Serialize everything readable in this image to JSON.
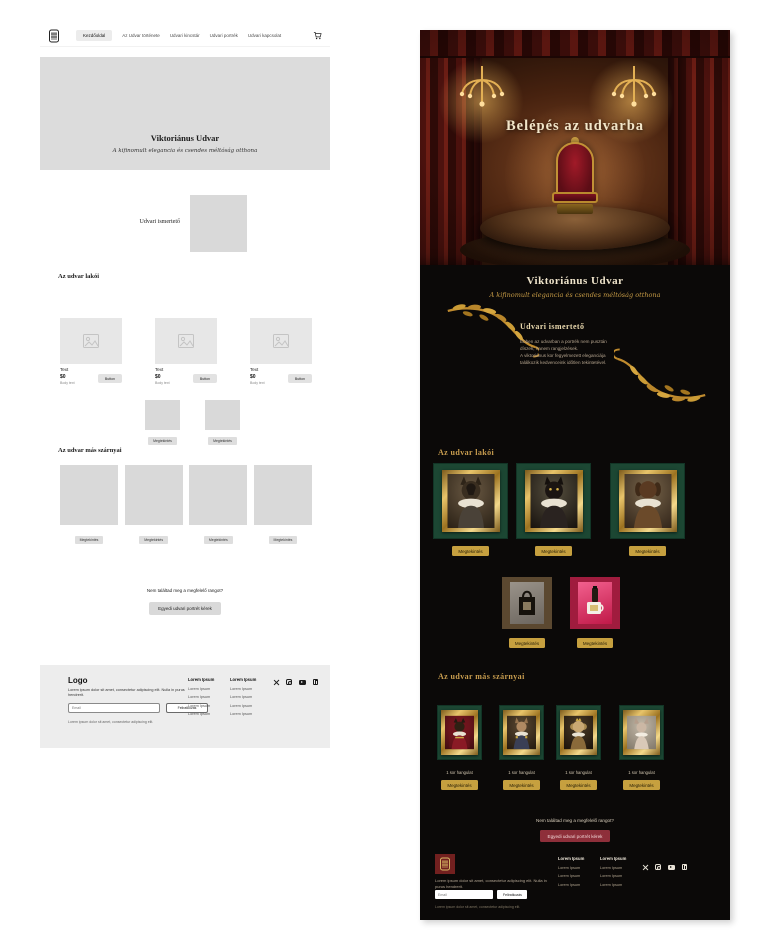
{
  "palette": {
    "gold": "#c6a03f",
    "gold_deep": "#b98a2e",
    "cream": "#efe4cb",
    "green_card": "#1c4733",
    "crimson_card": "#a01c3e",
    "brown_card": "#5b4830",
    "red_button": "#8e2f3a",
    "footer_logo_red": "#72201f",
    "dark_bg": "#0b0908",
    "wireframe_gray": "#d9d9d9"
  },
  "wireframe": {
    "nav": {
      "items": [
        "Kezdőoldal",
        "Az Udvar története",
        "Udvari kincstár",
        "Udvari portrék",
        "Udvari kapcsolat"
      ],
      "active_index": 0
    },
    "hero": {
      "title": "Viktoriánus Udvar",
      "subtitle": "A kifinomult elegancia és csendes méltóság otthona"
    },
    "intro": {
      "label": "Udvari ismertető"
    },
    "residents": {
      "heading": "Az udvar lakói",
      "cards": [
        {
          "title": "Text",
          "price": "$0",
          "body": "Body text",
          "button": "Button"
        },
        {
          "title": "Text",
          "price": "$0",
          "body": "Body text",
          "button": "Button"
        },
        {
          "title": "Text",
          "price": "$0",
          "body": "Body text",
          "button": "Button"
        }
      ]
    },
    "small_products": {
      "view_button": "Megtekintés"
    },
    "wings": {
      "heading": "Az udvar más szárnyai",
      "view_button": "Megtekintés"
    },
    "cta": {
      "question": "Nem találtad meg a megfelelő rangot?",
      "button": "Egyedi udvari portrét kérek"
    },
    "footer": {
      "logo": "Logo",
      "description": "Lorem ipsum dolor sit amet, consectetur adipiscing elit. Nulla in purus hendrerit.",
      "email_placeholder": "Email",
      "subscribe_button": "Feliratkozás",
      "note": "Lorem ipsum dolor sit amet, consectetur adipiscing elit.",
      "columns": [
        {
          "header": "Lorem Ipsum",
          "links": [
            "Lorem Ipsum",
            "Lorem Ipsum",
            "Lorem Ipsum",
            "Lorem Ipsum"
          ]
        },
        {
          "header": "Lorem Ipsum",
          "links": [
            "Lorem Ipsum",
            "Lorem Ipsum",
            "Lorem Ipsum",
            "Lorem Ipsum"
          ]
        }
      ],
      "socials": [
        "x",
        "instagram",
        "youtube",
        "linkedin"
      ]
    }
  },
  "design": {
    "hero": {
      "title": "Belépés az udvarba"
    },
    "title": "Viktoriánus Udvar",
    "subtitle": "A kifinomult elegancia és csendes méltóság otthona",
    "about": {
      "heading": "Udvari ismertető",
      "body": "Ebben az udvarban a portrék nem pusztán\ndíszek, hanem rangjelzések.\nA viktoriánus kor fegyelmezett eleganciája\ntalálkozik kedvenceink időtlen tekintetével."
    },
    "residents": {
      "heading": "Az udvar lakói",
      "cards": [
        {
          "portrait": "shepherd-dog-portrait",
          "button": "Megtekintés"
        },
        {
          "portrait": "black-cat-portrait",
          "button": "Megtekintés"
        },
        {
          "portrait": "dachshund-portrait",
          "button": "Megtekintés"
        }
      ]
    },
    "products": {
      "cards": [
        {
          "name": "tote-bag",
          "button": "Megtekintés"
        },
        {
          "name": "mug-and-bottle",
          "button": "Megtekintés"
        }
      ]
    },
    "wings": {
      "heading": "Az udvar más szárnyai",
      "cards": [
        {
          "caption": "1 sor hangulat",
          "button": "Megtekintés",
          "portrait": "dog-on-throne-portrait"
        },
        {
          "caption": "1 sor hangulat",
          "button": "Megtekintés",
          "portrait": "sphynx-officer-portrait"
        },
        {
          "caption": "1 sor hangulat",
          "button": "Megtekintés",
          "portrait": "pekingese-crown-portrait"
        },
        {
          "caption": "1 sor hangulat",
          "button": "Megtekintés",
          "portrait": "sphynx-cat-portrait"
        }
      ]
    },
    "cta": {
      "question": "Nem találtad meg a megfelelő rangot?",
      "button": "Egyedi udvari portrét kérek"
    },
    "footer": {
      "description": "Lorem ipsum dolor sit amet, consectetur adipiscing elit. Nulla in purus hendrerit.",
      "email_placeholder": "Email",
      "subscribe_button": "Feliratkozás",
      "note": "Lorem ipsum dolor sit amet, consectetur adipiscing elit.",
      "columns": [
        {
          "header": "Lorem Ipsum",
          "links": [
            "Lorem Ipsum",
            "Lorem Ipsum",
            "Lorem Ipsum"
          ]
        },
        {
          "header": "Lorem Ipsum",
          "links": [
            "Lorem Ipsum",
            "Lorem Ipsum",
            "Lorem Ipsum"
          ]
        }
      ],
      "socials": [
        "x",
        "instagram",
        "youtube",
        "linkedin"
      ]
    }
  }
}
